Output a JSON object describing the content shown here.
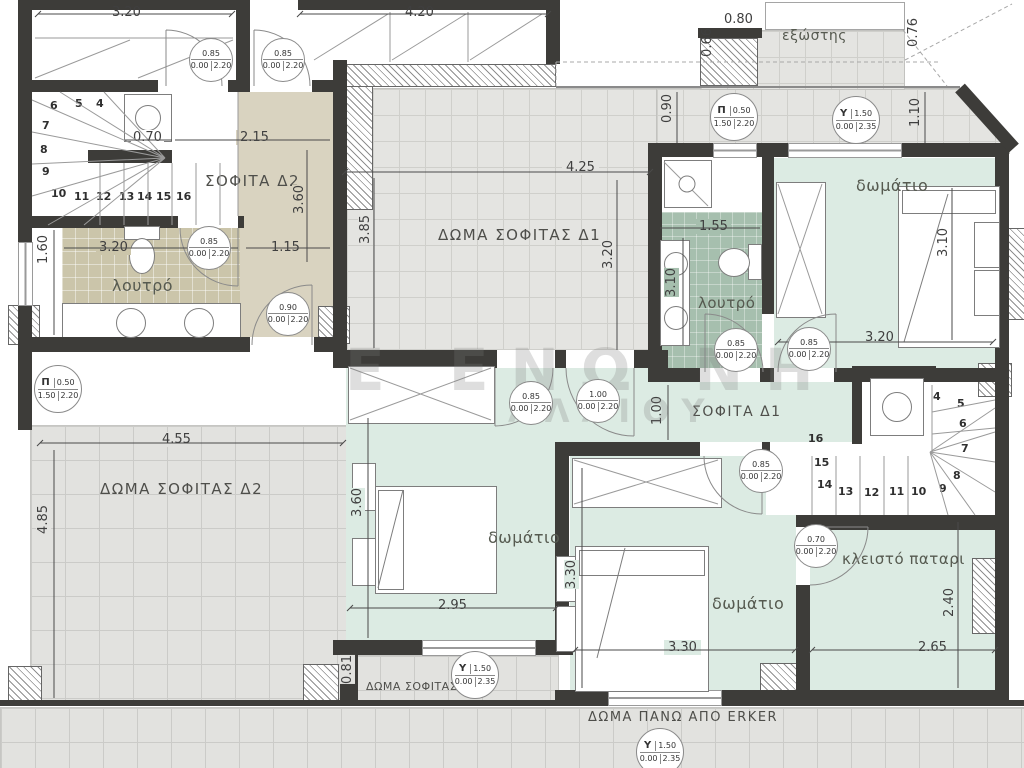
{
  "watermark": {
    "line1": "Ε ΕΝΩ ΝΗ",
    "line2": "ΑΛΑΙΟΥ"
  },
  "rooms": {
    "sofita_d2": "ΣΟΦΙΤΑ Δ2",
    "sofita_d1": "ΣΟΦΙΤΑ Δ1",
    "doma_d1": "ΔΩΜΑ ΣΟΦΙΤΑΣ Δ1",
    "doma_d2": "ΔΩΜΑ ΣΟΦΙΤΑΣ Δ2",
    "doma_1": "ΔΩΜΑ ΣΟΦΙΤΑΣ 1",
    "doma_erker": "ΔΩΜΑ ΠΑΝΩ ΑΠΟ ERKER",
    "loutro_left": "λουτρό",
    "loutro_right": "λουτρό",
    "bedroom_right": "δωμάτιο",
    "bedroom_mid": "δωμάτιο",
    "bedroom_bottom": "δωμάτιο",
    "patari": "κλειστό παταρι",
    "exostis": "εξώστης"
  },
  "dims": {
    "d320_top": "3.20",
    "d420": "4.20",
    "d080": "0.80",
    "d066": "0.66",
    "d076": "0.76",
    "d090": "0.90",
    "d110": "1.10",
    "d215": "2.15",
    "d070": "0.70",
    "d360_hall": "3.60",
    "d425": "4.25",
    "d385": "3.85",
    "d320_terr": "3.20",
    "d155": "1.55",
    "d310_bed": "3.10",
    "d320_bath": "3.20",
    "d115": "1.15",
    "d160": "1.60",
    "d310_bath": "3.10",
    "d320_bed": "3.20",
    "d100": "1.00",
    "d455": "4.55",
    "d485": "4.85",
    "d360_bed": "3.60",
    "d295": "2.95",
    "d330v": "3.30",
    "d330h": "3.30",
    "d240": "2.40",
    "d265": "2.65",
    "d081": "0.81"
  },
  "door_tags": [
    {
      "w": "0.85",
      "s": "0.00",
      "h": "2.20"
    },
    {
      "w": "0.85",
      "s": "0.00",
      "h": "2.20"
    },
    {
      "w": "0.85",
      "s": "0.00",
      "h": "2.20"
    },
    {
      "w": "0.90",
      "s": "0.00",
      "h": "2.20"
    },
    {
      "w": "0.85",
      "s": "0.00",
      "h": "2.20"
    },
    {
      "w": "1.00",
      "s": "0.00",
      "h": "2.20"
    },
    {
      "w": "0.85",
      "s": "0.00",
      "h": "2.20"
    },
    {
      "w": "0.85",
      "s": "0.00",
      "h": "2.20"
    },
    {
      "w": "0.85",
      "s": "0.00",
      "h": "2.20"
    },
    {
      "w": "0.70",
      "s": "0.00",
      "h": "2.20"
    }
  ],
  "window_tags": [
    {
      "letter": "Π",
      "w": "0.50",
      "s": "1.50",
      "h": "2.20"
    },
    {
      "letter": "Υ",
      "w": "1.50",
      "s": "0.00",
      "h": "2.35"
    },
    {
      "letter": "Π",
      "w": "0.50",
      "s": "1.50",
      "h": "2.20"
    },
    {
      "letter": "Υ",
      "w": "1.50",
      "s": "0.00",
      "h": "2.35"
    },
    {
      "letter": "Υ",
      "w": "1.50",
      "s": "0.00",
      "h": "2.35"
    }
  ],
  "stairs": {
    "left": [
      "4",
      "5",
      "6",
      "7",
      "8",
      "9",
      "10",
      "11",
      "12",
      "13",
      "14",
      "15",
      "16"
    ],
    "right": [
      "4",
      "5",
      "6",
      "7",
      "8",
      "9",
      "10",
      "11",
      "12",
      "13",
      "14",
      "15",
      "16"
    ]
  }
}
